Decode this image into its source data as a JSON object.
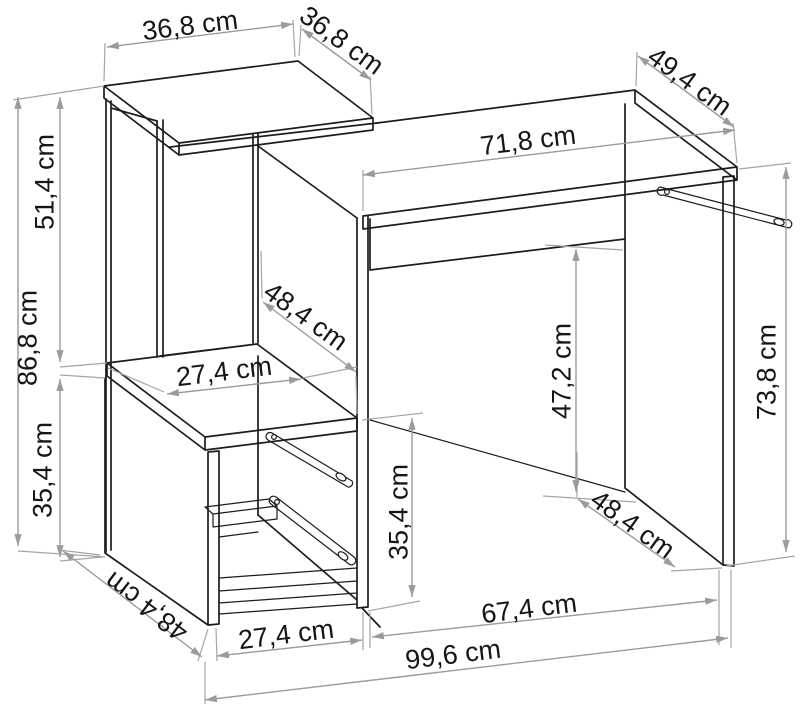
{
  "figure": {
    "type": "furniture-dimension-diagram",
    "subject": "desk-with-shelf-unit",
    "unit": "cm",
    "background_color": "#ffffff",
    "line_color": "#1c1c1c",
    "dimension_color": "#9b9b9b",
    "text_color": "#161616"
  },
  "dimensions": {
    "shelf_top_width": {
      "label": "36,8 cm",
      "value": 36.8
    },
    "shelf_top_depth": {
      "label": "36,8 cm",
      "value": 36.8
    },
    "desktop_depth": {
      "label": "49,4 cm",
      "value": 49.4
    },
    "desktop_width": {
      "label": "71,8 cm",
      "value": 71.8
    },
    "upper_section_height": {
      "label": "51,4 cm",
      "value": 51.4
    },
    "left_unit_height": {
      "label": "86,8 cm",
      "value": 86.8
    },
    "lower_section_height": {
      "label": "35,4 cm",
      "value": 35.4
    },
    "side_panel_depth_mid": {
      "label": "48,4 cm",
      "value": 48.4
    },
    "shelf_inner_width": {
      "label": "27,4 cm",
      "value": 27.4
    },
    "lower_inner_height": {
      "label": "35,4 cm",
      "value": 35.4
    },
    "knee_space_height": {
      "label": "47,2 cm",
      "value": 47.2
    },
    "desk_height": {
      "label": "73,8 cm",
      "value": 73.8
    },
    "right_panel_depth": {
      "label": "48,4 cm",
      "value": 48.4
    },
    "left_panel_depth": {
      "label": "48,4 cm",
      "value": 48.4
    },
    "drawer_front_width": {
      "label": "27,4 cm",
      "value": 27.4
    },
    "knee_space_width": {
      "label": "67,4 cm",
      "value": 67.4
    },
    "total_width": {
      "label": "99,6 cm",
      "value": 99.6
    }
  }
}
